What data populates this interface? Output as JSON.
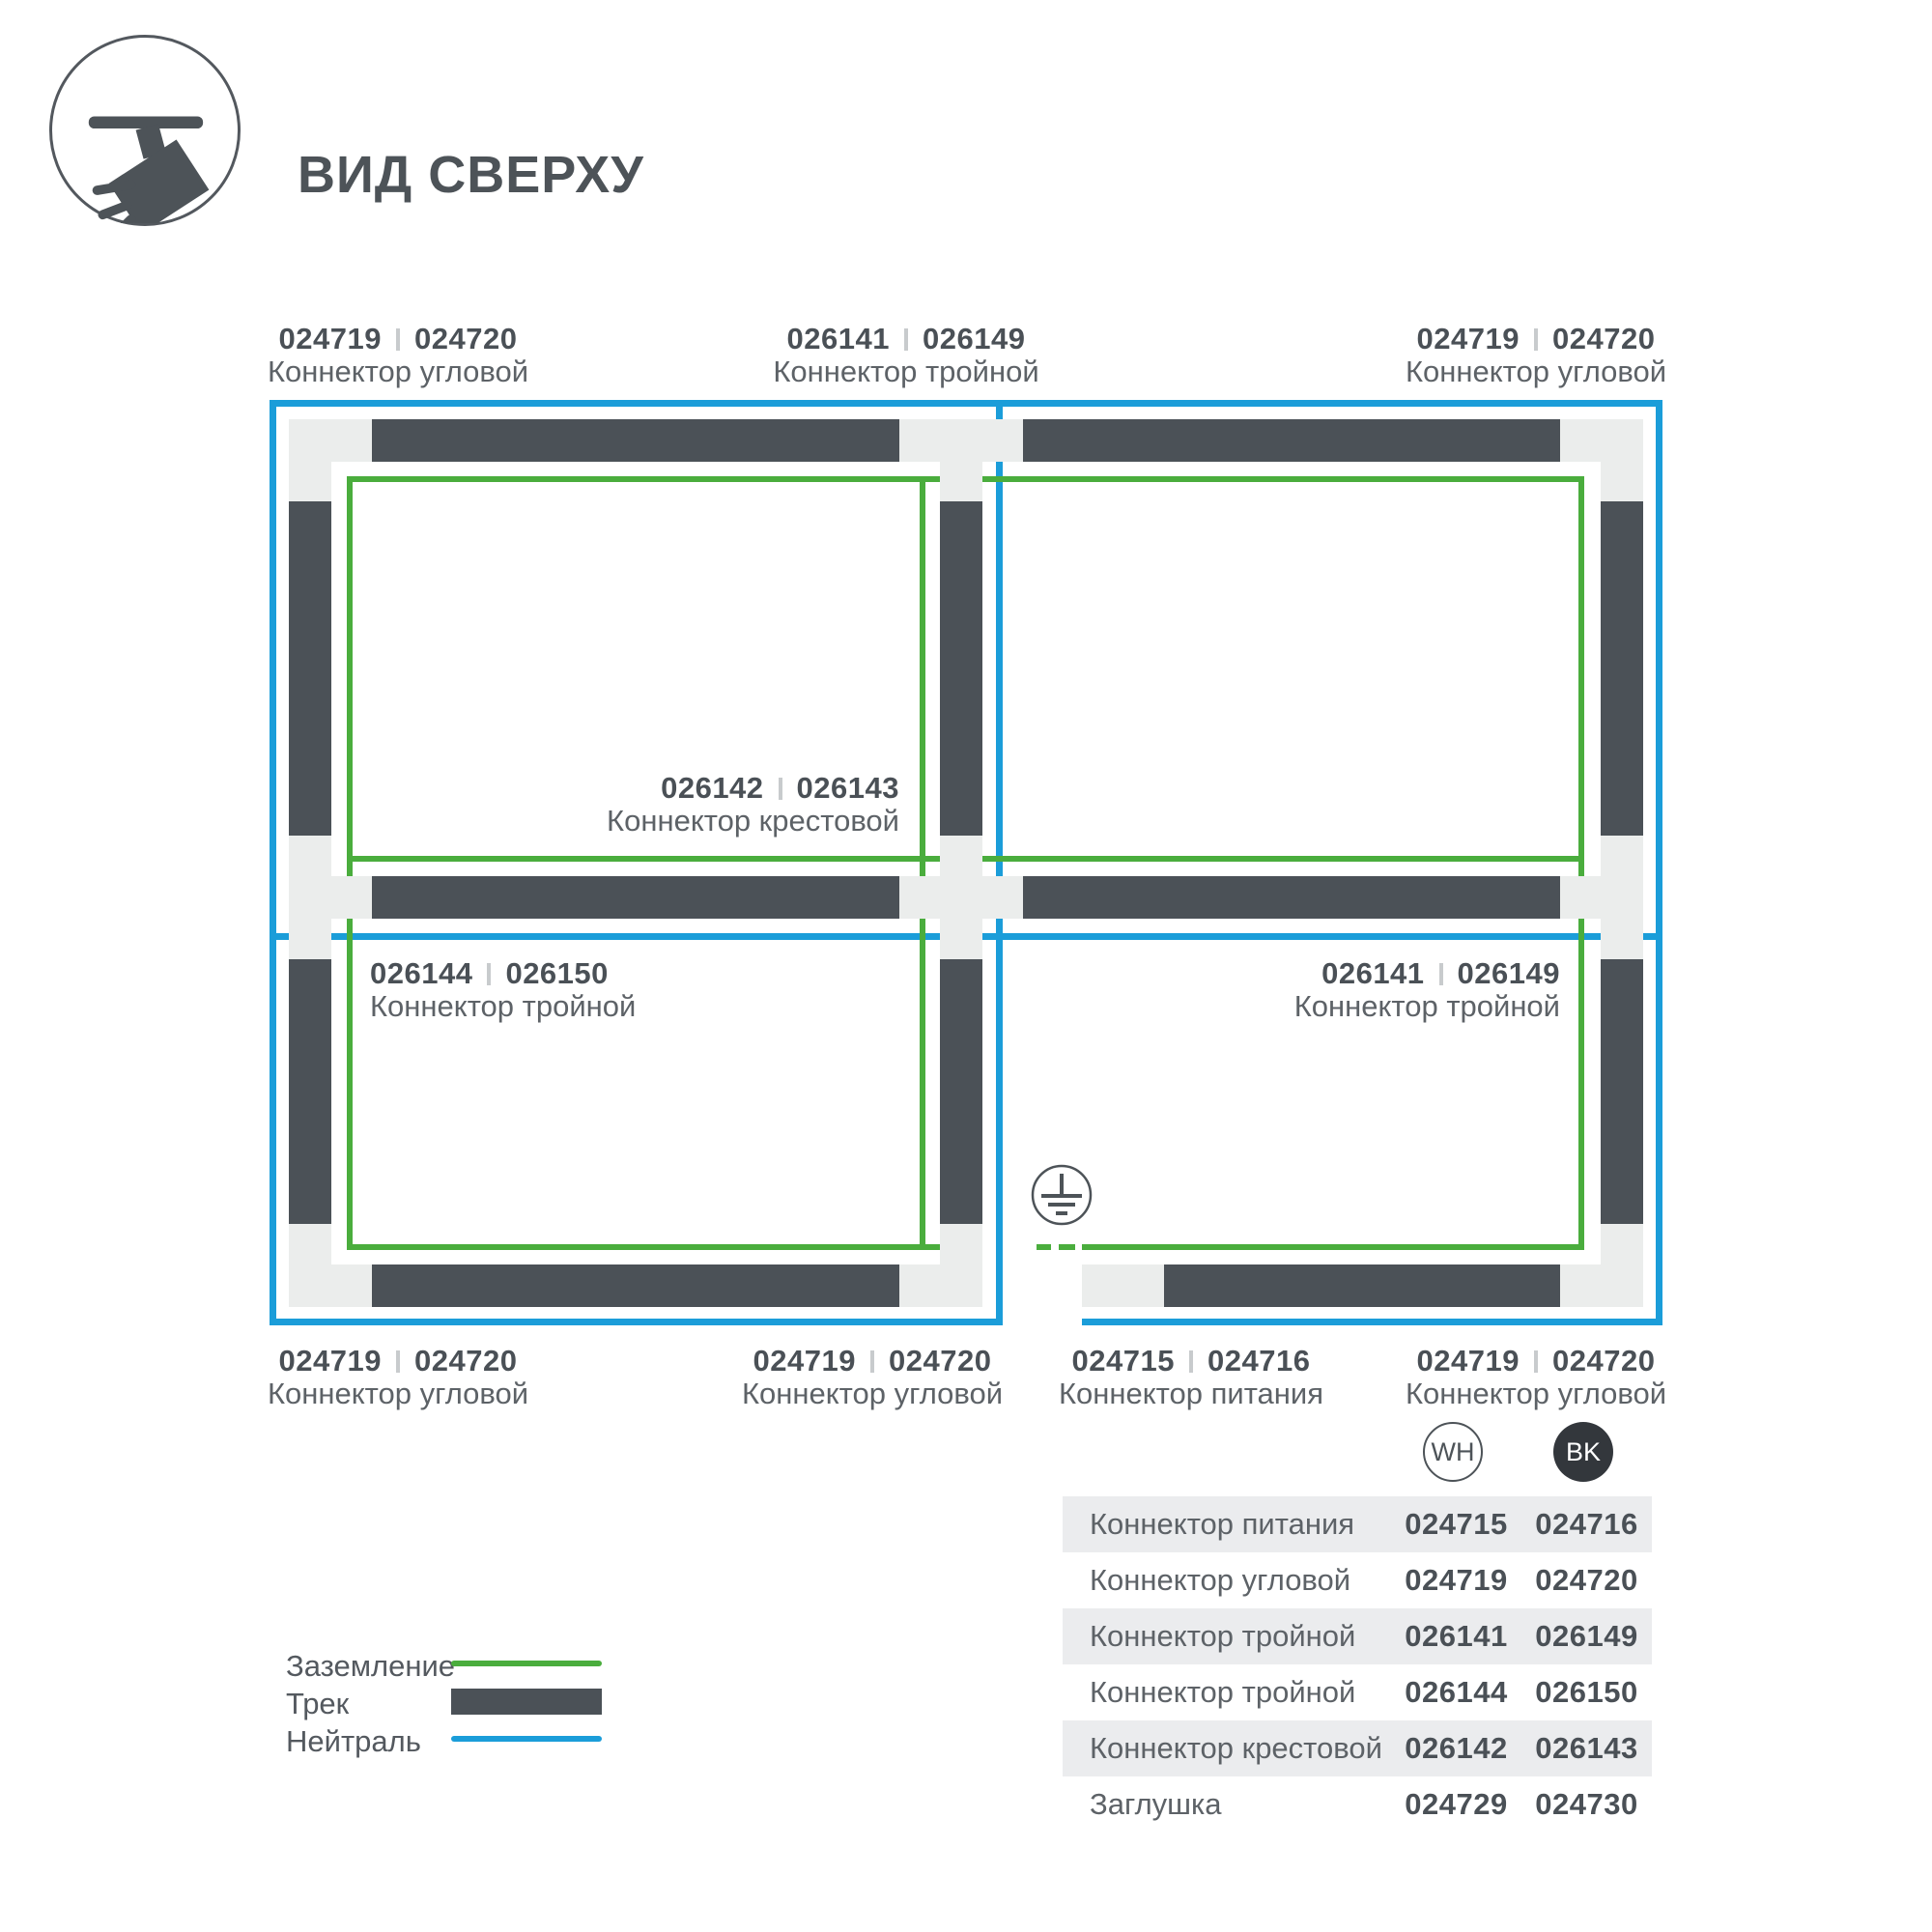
{
  "header": {
    "title": "ВИД СВЕРХУ"
  },
  "colors": {
    "track_dark": "#4b5157",
    "track_bed_light": "#ebedec",
    "ground_green": "#4aad3d",
    "neutral_blue": "#1b9dd9"
  },
  "diagram": {
    "labels": [
      {
        "num1": "024719",
        "num2": "024720",
        "name": "Коннектор угловой"
      },
      {
        "num1": "026141",
        "num2": "026149",
        "name": "Коннектор тройной"
      },
      {
        "num1": "024719",
        "num2": "024720",
        "name": "Коннектор угловой"
      },
      {
        "num1": "026142",
        "num2": "026143",
        "name": "Коннектор крестовой"
      },
      {
        "num1": "026144",
        "num2": "026150",
        "name": "Коннектор тройной"
      },
      {
        "num1": "026141",
        "num2": "026149",
        "name": "Коннектор тройной"
      },
      {
        "num1": "024719",
        "num2": "024720",
        "name": "Коннектор угловой"
      },
      {
        "num1": "024719",
        "num2": "024720",
        "name": "Коннектор угловой"
      },
      {
        "num1": "024715",
        "num2": "024716",
        "name": "Коннектор питания"
      },
      {
        "num1": "024719",
        "num2": "024720",
        "name": "Коннектор угловой"
      }
    ]
  },
  "legend": {
    "items": [
      {
        "label": "Заземление",
        "swatch": "ground-line"
      },
      {
        "label": "Трек",
        "swatch": "track-bar"
      },
      {
        "label": "Нейтраль",
        "swatch": "neutral-line"
      }
    ]
  },
  "parts_table": {
    "columns": {
      "wh": "WH",
      "bk": "BK"
    },
    "rows": [
      {
        "name": "Коннектор питания",
        "wh": "024715",
        "bk": "024716"
      },
      {
        "name": "Коннектор угловой",
        "wh": "024719",
        "bk": "024720"
      },
      {
        "name": "Коннектор тройной",
        "wh": "026141",
        "bk": "026149"
      },
      {
        "name": "Коннектор тройной",
        "wh": "026144",
        "bk": "026150"
      },
      {
        "name": "Коннектор крестовой",
        "wh": "026142",
        "bk": "026143"
      },
      {
        "name": "Заглушка",
        "wh": "024729",
        "bk": "024730"
      }
    ]
  }
}
